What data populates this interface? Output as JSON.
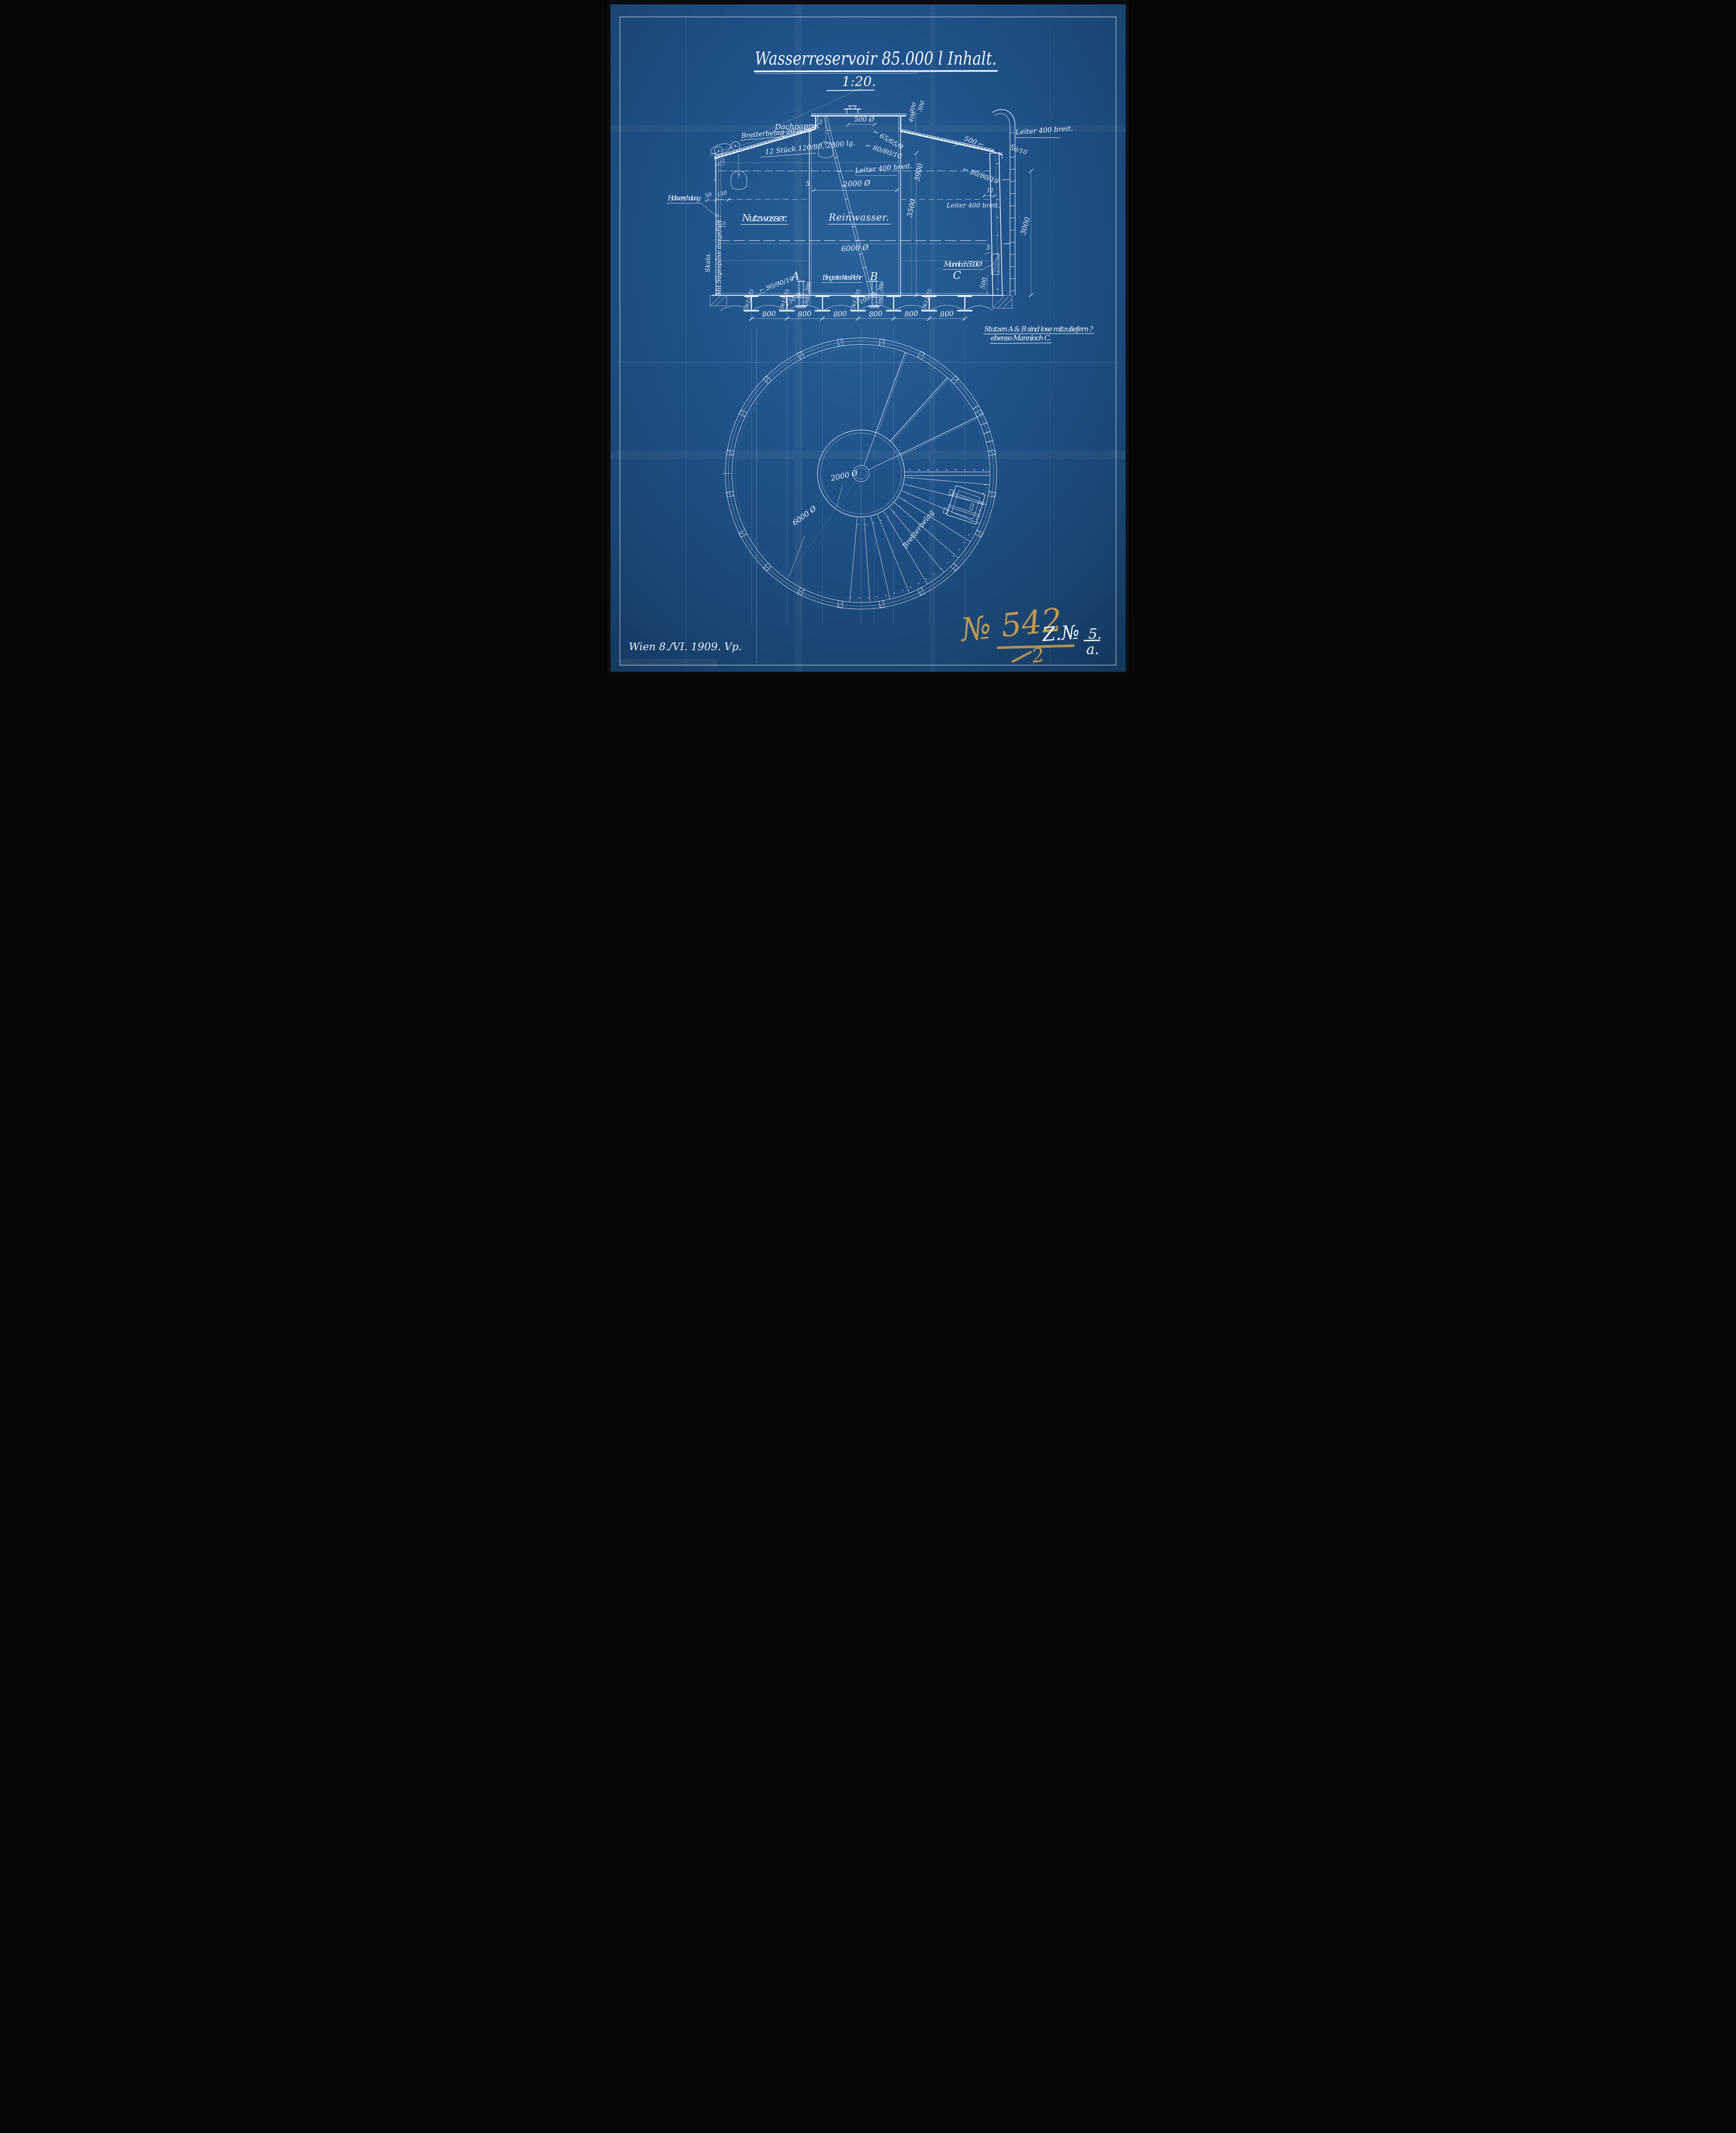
{
  "title": {
    "main": "Wasserreservoir 85.000 l Inhalt.",
    "scale": "1:20."
  },
  "colors": {
    "paper": "#1d4e81",
    "ink": "#e9f3fd",
    "crayon": "#d9a44b"
  },
  "section": {
    "labels": {
      "dachpappe": "Dachpappe.",
      "bretterbelag": "Bretterbelag 20 m/m",
      "stueck": "12 Stück 120/80, 2300 lg.",
      "holzverschalung": "Holzverschalung",
      "skala": "Skala.",
      "saegespaene": "Mit Sägespäne ausgefüllt ?",
      "nutzwasser": "Nutzwasser.",
      "reinwasser": "Reinwasser.",
      "leiter": "Leiter 400 breit.",
      "eingestecktes_rohr": "Eingestecktes Rohr",
      "mannloch": "Mannloch 500 Ø",
      "mannloch_c": "C",
      "stutzen_a": "A",
      "stutzen_b": "B",
      "winkel_65": "⌐ 65/65/9",
      "winkel_80": "⌐ 80/80/10",
      "winkel_90": "⌐ 90/90/10",
      "winkel_500": "500 ⌐",
      "flacheisen": "50/10",
      "traeger": "I №12 35",
      "kuppel_durchmesser": "500 Ø",
      "rohr_a_durchmesser": "150 Ø",
      "rohr_b_durchmesser": "100 Ø",
      "tank_durchmesser": "6000 Ø",
      "mittelrohr_durchmesser": "2000 Ø"
    },
    "dims": {
      "d800": "800",
      "d3900": "3900",
      "d3500": "3500",
      "d3000": "3000",
      "d300": "300",
      "d400": "400",
      "d500": "500",
      "d150": "150",
      "d50": "50",
      "d12": "12",
      "d5": "5",
      "d3": "3"
    }
  },
  "plan": {
    "labels": {
      "mittelrohr": "2000 Ø",
      "tank": "6000 Ø",
      "bretterbelag": "Bretterbelag"
    }
  },
  "notes": {
    "line1": "Stutzen A & B sind lose mitzuliefern ?",
    "line2": "ebenso Mannloch C."
  },
  "footer": {
    "date": "Wien 8./VI. 1909. Vp.",
    "order_number": "№ 542",
    "order_denominator": "2",
    "zeichnung": "Z.№",
    "blatt_top": "5.",
    "blatt_bottom": "a."
  }
}
